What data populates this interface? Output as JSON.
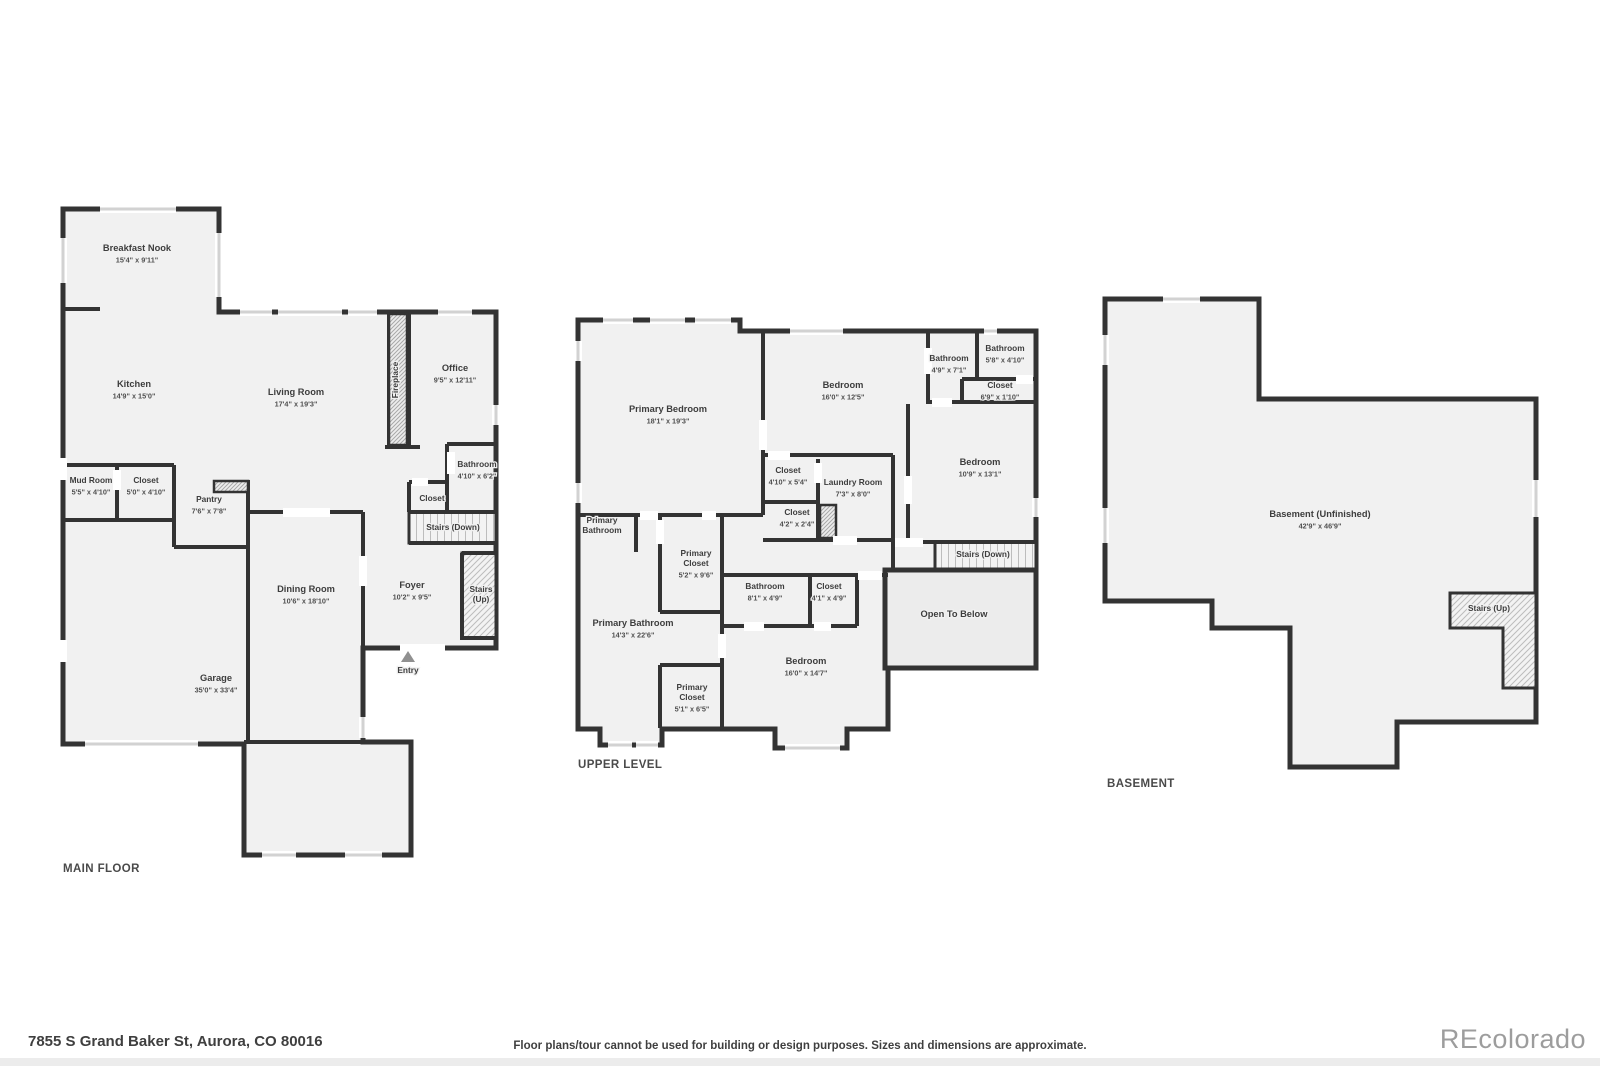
{
  "page": {
    "address": "7855 S Grand Baker St, Aurora, CO 80016",
    "disclaimer": "Floor plans/tour cannot be used for building or design purposes. Sizes and dimensions are approximate.",
    "brand": "REcolorado"
  },
  "colors": {
    "wall": "#333333",
    "floor": "#f1f1f1",
    "window_bar": "#d2d2d2",
    "entry_arrow": "#909090",
    "brand_gray": "#9d9d9d"
  },
  "floors": [
    {
      "id": "main",
      "title": "MAIN FLOOR",
      "rooms": [
        {
          "x": 137,
          "y": 251,
          "name": [
            "Breakfast Nook"
          ],
          "dims": "15'4\" x 9'11\""
        },
        {
          "x": 134,
          "y": 387,
          "name": [
            "Kitchen"
          ],
          "dims": "14'9\" x 15'0\""
        },
        {
          "x": 296,
          "y": 395,
          "name": [
            "Living Room"
          ],
          "dims": "17'4\" x 19'3\""
        },
        {
          "x": 455,
          "y": 371,
          "name": [
            "Office"
          ],
          "dims": "9'5\" x 12'11\""
        },
        {
          "x": 398,
          "y": 380,
          "name": [
            "Fireplace"
          ],
          "rotate": true,
          "small": true
        },
        {
          "x": 91,
          "y": 483,
          "name": [
            "Mud Room"
          ],
          "dims": "5'5\" x 4'10\"",
          "small": true
        },
        {
          "x": 146,
          "y": 483,
          "name": [
            "Closet"
          ],
          "dims": "5'0\" x 4'10\"",
          "small": true
        },
        {
          "x": 209,
          "y": 502,
          "name": [
            "Pantry"
          ],
          "dims": "7'6\" x 7'8\"",
          "small": true
        },
        {
          "x": 477,
          "y": 467,
          "name": [
            "Bathroom"
          ],
          "dims": "4'10\" x 6'2\"",
          "small": true
        },
        {
          "x": 432,
          "y": 501,
          "name": [
            "Closet"
          ],
          "small": true
        },
        {
          "x": 453,
          "y": 530,
          "name": [
            "Stairs (Down)"
          ],
          "small": true
        },
        {
          "x": 306,
          "y": 592,
          "name": [
            "Dining Room"
          ],
          "dims": "10'6\" x 18'10\""
        },
        {
          "x": 412,
          "y": 588,
          "name": [
            "Foyer"
          ],
          "dims": "10'2\" x 9'5\""
        },
        {
          "x": 481,
          "y": 592,
          "name": [
            "Stairs",
            "(Up)"
          ],
          "small": true
        },
        {
          "x": 216,
          "y": 681,
          "name": [
            "Garage"
          ],
          "dims": "35'0\" x 33'4\""
        },
        {
          "x": 408,
          "y": 673,
          "name": [
            "Entry"
          ],
          "small": true
        }
      ]
    },
    {
      "id": "upper",
      "title": "UPPER LEVEL",
      "rooms": [
        {
          "x": 668,
          "y": 412,
          "name": [
            "Primary Bedroom"
          ],
          "dims": "18'1\" x 19'3\""
        },
        {
          "x": 843,
          "y": 388,
          "name": [
            "Bedroom"
          ],
          "dims": "16'0\" x 12'5\""
        },
        {
          "x": 949,
          "y": 361,
          "name": [
            "Bathroom"
          ],
          "dims": "4'9\" x 7'1\"",
          "small": true
        },
        {
          "x": 1005,
          "y": 351,
          "name": [
            "Bathroom"
          ],
          "dims": "5'8\" x 4'10\"",
          "small": true
        },
        {
          "x": 1000,
          "y": 388,
          "name": [
            "Closet"
          ],
          "dims": "6'9\" x 1'10\"",
          "small": true
        },
        {
          "x": 980,
          "y": 465,
          "name": [
            "Bedroom"
          ],
          "dims": "10'9\" x 13'1\""
        },
        {
          "x": 788,
          "y": 473,
          "name": [
            "Closet"
          ],
          "dims": "4'10\" x 5'4\"",
          "small": true
        },
        {
          "x": 853,
          "y": 485,
          "name": [
            "Laundry Room"
          ],
          "dims": "7'3\" x 8'0\"",
          "small": true
        },
        {
          "x": 797,
          "y": 515,
          "name": [
            "Closet"
          ],
          "dims": "4'2\" x 2'4\"",
          "small": true
        },
        {
          "x": 602,
          "y": 523,
          "name": [
            "Primary",
            "Bathroom"
          ],
          "small": true
        },
        {
          "x": 696,
          "y": 556,
          "name": [
            "Primary",
            "Closet"
          ],
          "dims": "5'2\" x 9'6\"",
          "small": true
        },
        {
          "x": 633,
          "y": 626,
          "name": [
            "Primary Bathroom"
          ],
          "dims": "14'3\" x 22'6\""
        },
        {
          "x": 692,
          "y": 690,
          "name": [
            "Primary",
            "Closet"
          ],
          "dims": "5'1\" x 6'5\"",
          "small": true
        },
        {
          "x": 765,
          "y": 589,
          "name": [
            "Bathroom"
          ],
          "dims": "8'1\" x 4'9\"",
          "small": true
        },
        {
          "x": 829,
          "y": 589,
          "name": [
            "Closet"
          ],
          "dims": "4'1\" x 4'9\"",
          "small": true
        },
        {
          "x": 806,
          "y": 664,
          "name": [
            "Bedroom"
          ],
          "dims": "16'0\" x 14'7\""
        },
        {
          "x": 954,
          "y": 617,
          "name": [
            "Open To Below"
          ]
        },
        {
          "x": 983,
          "y": 557,
          "name": [
            "Stairs (Down)"
          ],
          "small": true
        }
      ]
    },
    {
      "id": "basement",
      "title": "BASEMENT",
      "rooms": [
        {
          "x": 1320,
          "y": 517,
          "name": [
            "Basement (Unfinished)"
          ],
          "dims": "42'9\" x 46'9\""
        },
        {
          "x": 1489,
          "y": 611,
          "name": [
            "Stairs (Up)"
          ],
          "small": true
        }
      ]
    }
  ]
}
